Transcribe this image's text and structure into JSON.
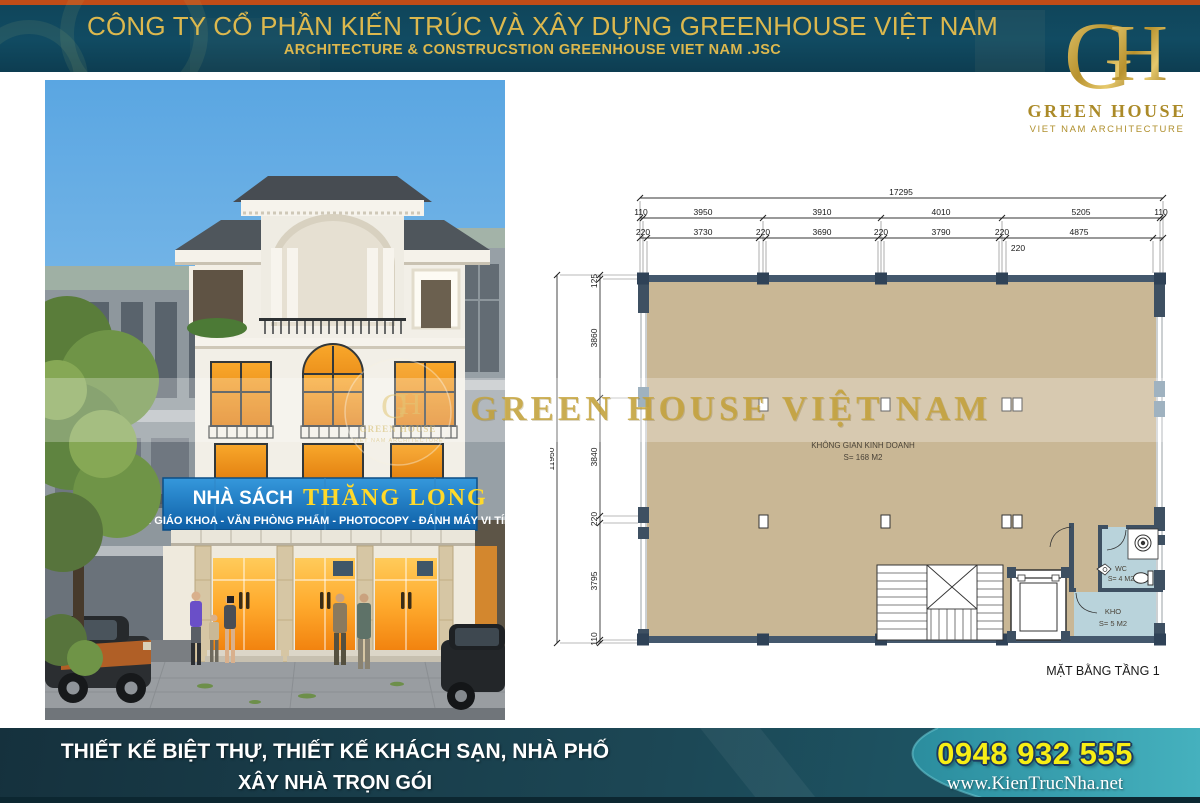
{
  "header": {
    "title": "CÔNG TY CỔ PHẦN KIẾN TRÚC VÀ XÂY DỰNG GREENHOUSE VIỆT NAM",
    "subtitle": "ARCHITECTURE & CONSTRUCSTION GREENHOUSE VIET NAM .JSC"
  },
  "logo": {
    "monogram_g": "G",
    "monogram_h": "H",
    "name": "GREEN HOUSE",
    "tagline": "VIET NAM ARCHITECTURE"
  },
  "watermark": {
    "text": "GREEN HOUSE VIỆT NAM"
  },
  "building_render": {
    "sign_prefix": "NHÀ SÁCH",
    "sign_name": "THĂNG LONG",
    "sign_services": "SÁCH GIÁO KHOA - VĂN PHÒNG PHẨM - PHOTOCOPY - ĐÁNH MÁY VI TÍNH"
  },
  "floor_plan": {
    "title": "MẶT BẰNG TẦNG 1",
    "room_main_line1": "KHÔNG GIAN KINH DOANH",
    "room_main_line2": "S= 168 M2",
    "room_wc_line1": "WC",
    "room_wc_line2": "S= 4 M2",
    "room_kho_line1": "KHO",
    "room_kho_line2": "S= 5 M2",
    "dim_total_width": "17295",
    "dim_total_height": "11950",
    "dims_top_axis": [
      "110",
      "3950",
      "3910",
      "4010",
      "5205",
      "110"
    ],
    "dims_top_wall": [
      "220",
      "3730",
      "220",
      "3690",
      "220",
      "3790",
      "220",
      "4875"
    ],
    "dim_top_extra": "220",
    "dims_left_axis": [
      "125",
      "3860",
      "3840",
      "220",
      "3795",
      "110"
    ]
  },
  "footer": {
    "line1": "THIẾT KẾ BIỆT THỰ, THIẾT KẾ KHÁCH SẠN, NHÀ PHỐ",
    "line2": "XÂY NHÀ TRỌN GÓI",
    "phone": "0948 932 555",
    "website": "www.KienTrucNha.net"
  },
  "colors": {
    "header_bg": "#114b62",
    "header_accent": "#c04c18",
    "gold": "#dcb84e",
    "sign_blue": "#1779c4",
    "plan_floor": "#c9b795",
    "plan_wall": "#3e5062",
    "plan_room_blue": "#b9d3db",
    "footer_dark": "#1c4755",
    "footer_light": "#2d96a6",
    "phone_yellow": "#f7ee15"
  }
}
